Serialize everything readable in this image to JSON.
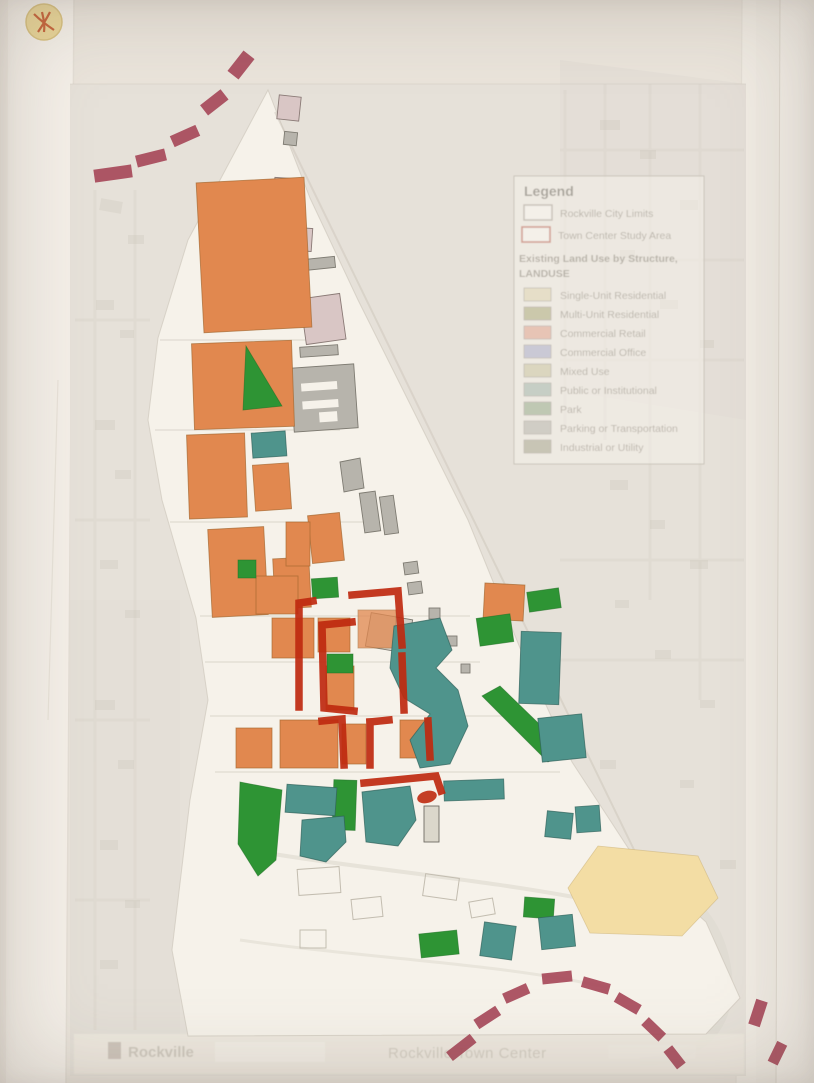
{
  "colors": {
    "red_marker": "#bf2a10",
    "maroon_dash": "#a84a5b",
    "orange_retail": "#e1884f",
    "green_park": "#2e9434",
    "teal_institutional": "#4f948c",
    "tan_area": "#f3dda4",
    "gray_building": "#b7b4ac",
    "pink_building": "#d9c6c5",
    "paper_white": "#f6f2ea",
    "underlay_map": "#ddd8cf"
  },
  "legend": {
    "title": "Legend",
    "boundaries": [
      {
        "label": "Rockville City Limits",
        "swatch": "gray-outline"
      },
      {
        "label": "Town Center Study Area",
        "swatch": "red-outline"
      }
    ],
    "subtitle": "Existing Land Use by Structure,",
    "subtitle2": "LANDUSE",
    "categories": [
      {
        "label": "Single-Unit Residential",
        "color": "#ddd3ae"
      },
      {
        "label": "Multi-Unit Residential",
        "color": "#a9a878"
      },
      {
        "label": "Commercial Retail",
        "color": "#dfa08c"
      },
      {
        "label": "Commercial Office",
        "color": "#a8abc9"
      },
      {
        "label": "Mixed Use",
        "color": "#c9c39e"
      },
      {
        "label": "Public or Institutional",
        "color": "#9fb4a9"
      },
      {
        "label": "Park",
        "color": "#93a886"
      },
      {
        "label": "Parking or Transportation",
        "color": "#b3b3a9"
      },
      {
        "label": "Industrial or Utility",
        "color": "#a5a28b"
      }
    ]
  },
  "footer": {
    "brand": "Rockville",
    "title": "Rockville Town Center"
  }
}
